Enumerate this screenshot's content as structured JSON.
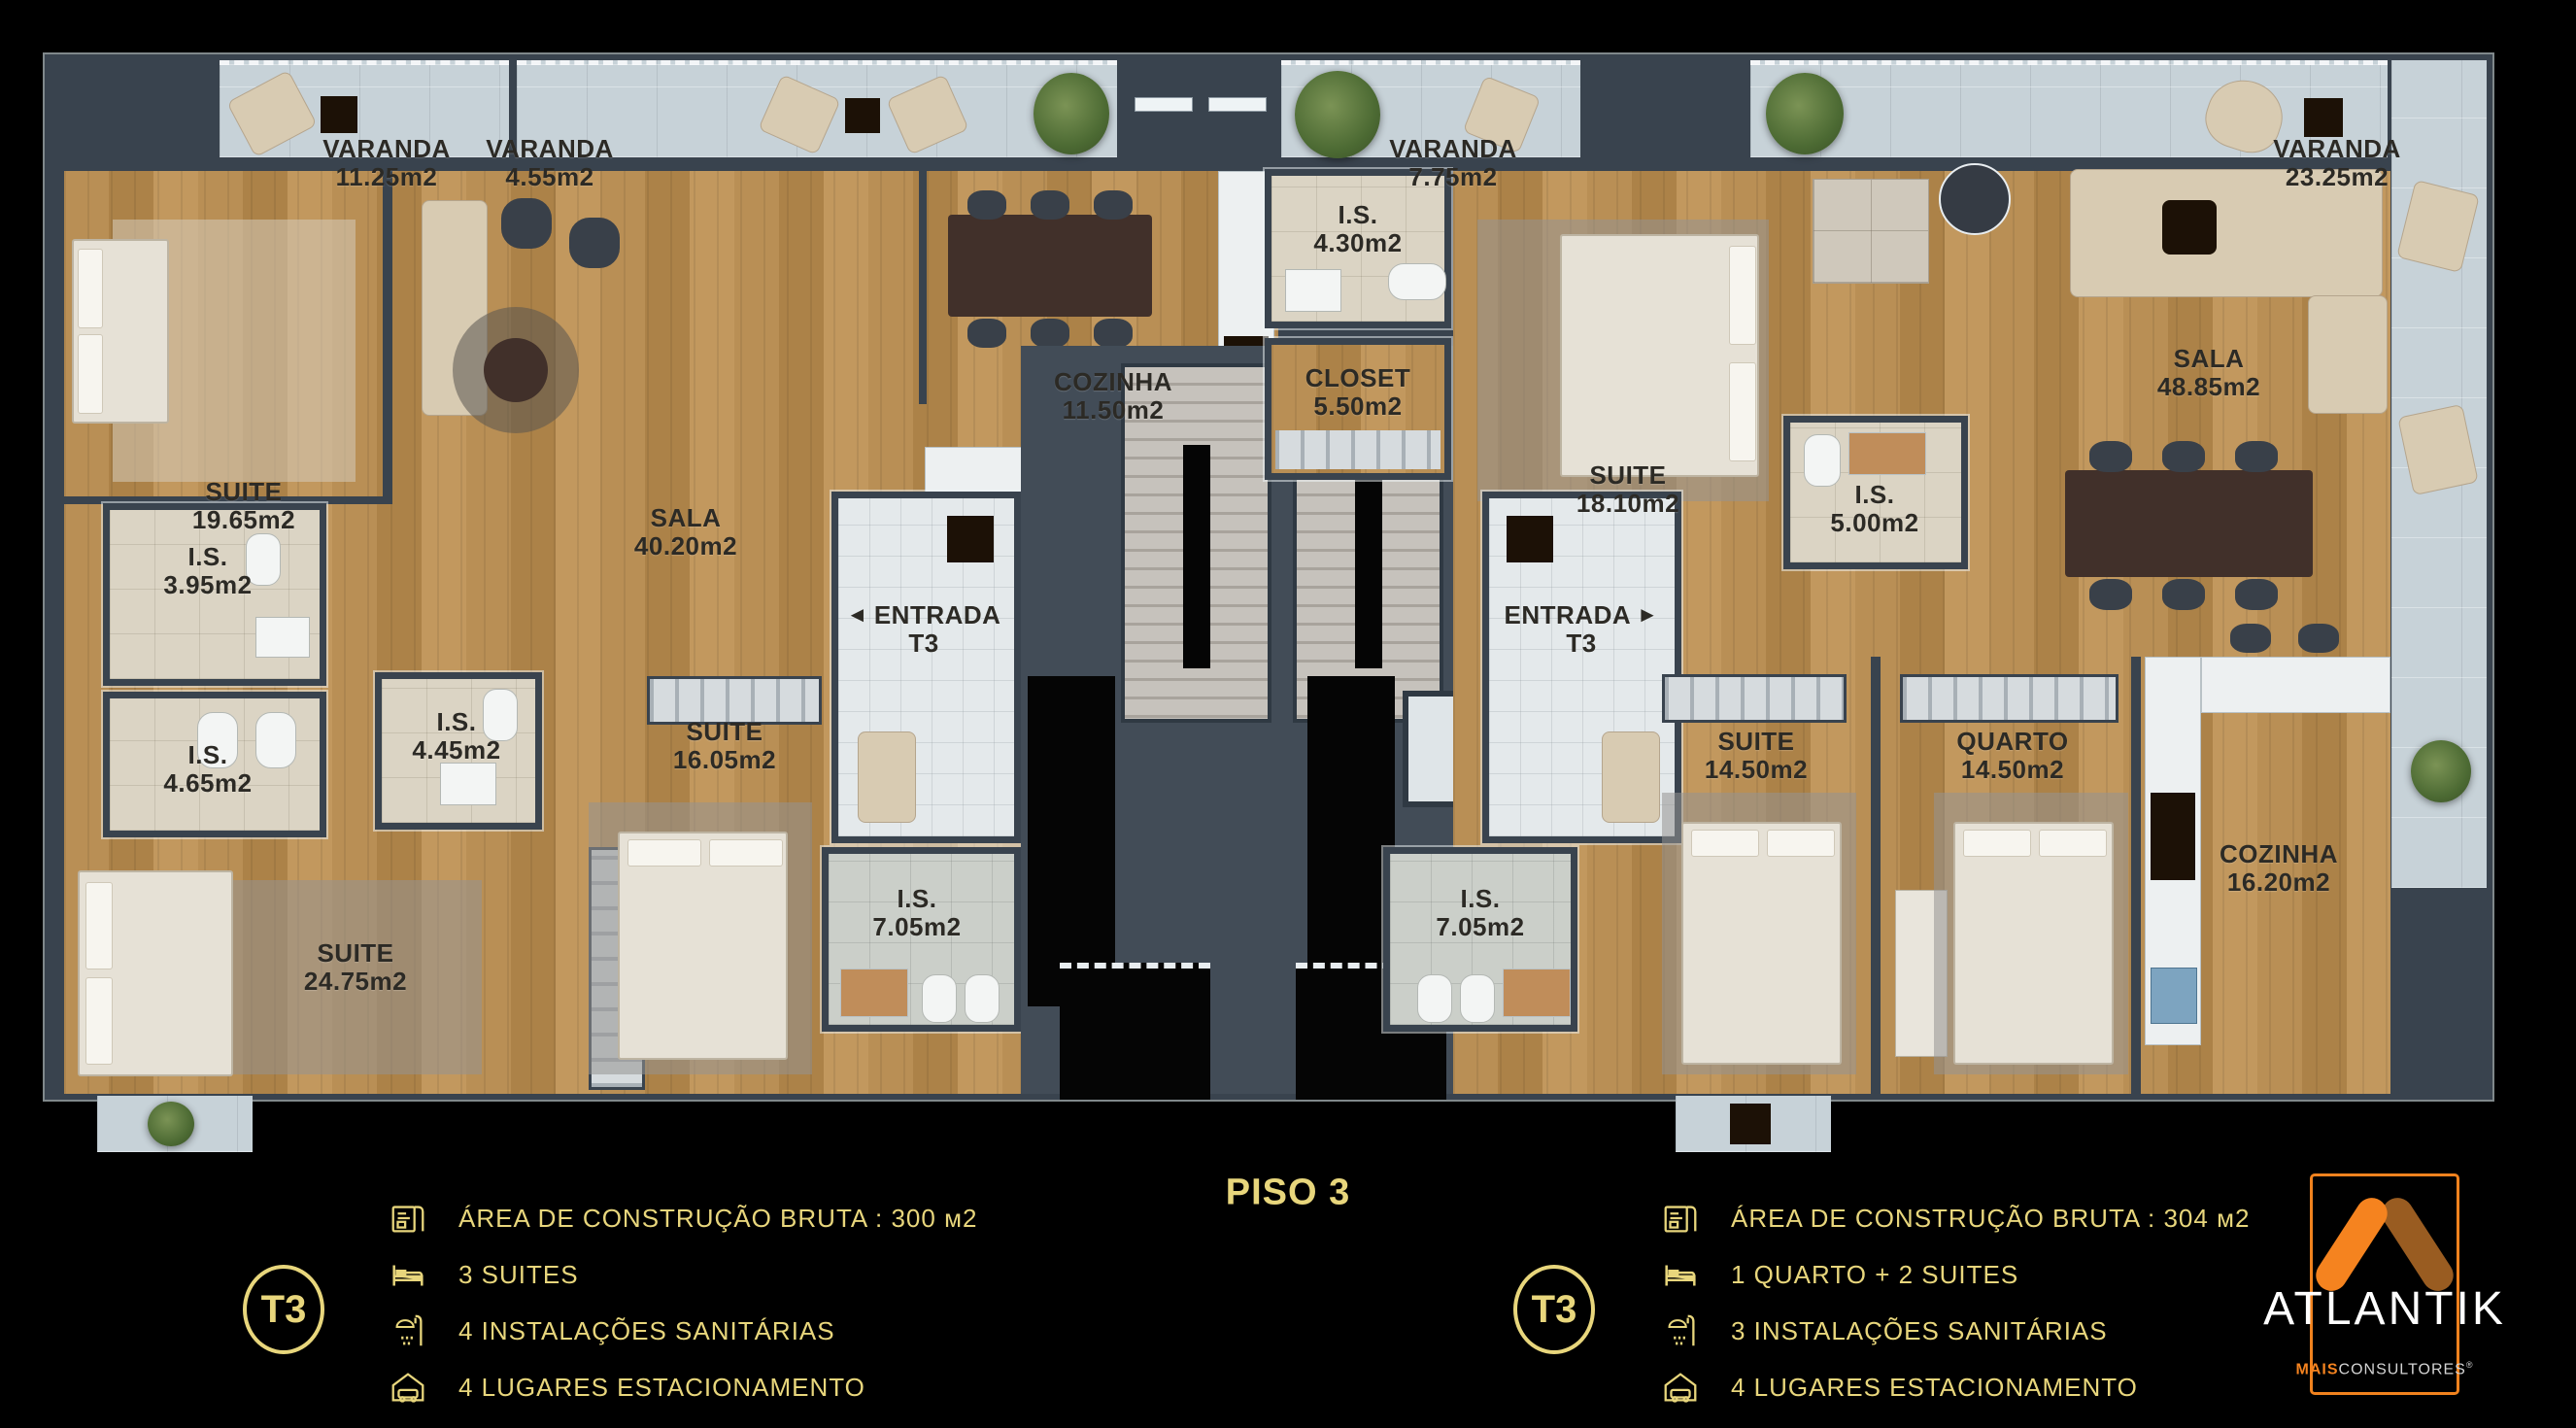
{
  "floor": {
    "label": "PISO 3"
  },
  "plan": {
    "varandas": [
      {
        "name": "VARANDA",
        "area": "4.55m2"
      },
      {
        "name": "VARANDA",
        "area": "11.25m2"
      },
      {
        "name": "VARANDA",
        "area": "7.75m2"
      },
      {
        "name": "VARANDA",
        "area": "23.25m2"
      }
    ],
    "left_unit": {
      "suite1": {
        "name": "SUITE",
        "area": "19.65m2"
      },
      "sala": {
        "name": "SALA",
        "area": "40.20m2"
      },
      "cozinha": {
        "name": "COZINHA",
        "area": "11.50m2"
      },
      "is1": {
        "name": "I.S.",
        "area": "3.95m2"
      },
      "is2": {
        "name": "I.S.",
        "area": "4.65m2"
      },
      "is3": {
        "name": "I.S.",
        "area": "4.45m2"
      },
      "suite2": {
        "name": "SUITE",
        "area": "24.75m2"
      },
      "suite3": {
        "name": "SUITE",
        "area": "16.05m2"
      },
      "entrada": {
        "arrow": "◄",
        "name": "ENTRADA",
        "sub": "T3"
      },
      "is4": {
        "name": "I.S.",
        "area": "7.05m2"
      }
    },
    "right_unit": {
      "is1": {
        "name": "I.S.",
        "area": "4.30m2"
      },
      "closet": {
        "name": "CLOSET",
        "area": "5.50m2"
      },
      "suite1": {
        "name": "SUITE",
        "area": "18.10m2"
      },
      "is2": {
        "name": "I.S.",
        "area": "5.00m2"
      },
      "sala": {
        "name": "SALA",
        "area": "48.85m2"
      },
      "entrada": {
        "name": "ENTRADA",
        "arrow": "►",
        "sub": "T3"
      },
      "suite2": {
        "name": "SUITE",
        "area": "14.50m2"
      },
      "quarto": {
        "name": "QUARTO",
        "area": "14.50m2"
      },
      "cozinha": {
        "name": "COZINHA",
        "area": "16.20m2"
      },
      "is3": {
        "name": "I.S.",
        "area": "7.05m2"
      }
    }
  },
  "legend": {
    "left": {
      "badge": "T3",
      "items": [
        {
          "icon": "blueprint-icon",
          "text": "ÁREA DE CONSTRUÇÃO BRUTA :  300 м2"
        },
        {
          "icon": "bed-icon",
          "text": "3 SUITES"
        },
        {
          "icon": "shower-icon",
          "text": "4 INSTALAÇÕES SANITÁRIAS"
        },
        {
          "icon": "garage-icon",
          "text": "4 LUGARES ESTACIONAMENTO"
        }
      ]
    },
    "right": {
      "badge": "T3",
      "items": [
        {
          "icon": "blueprint-icon",
          "text": "ÁREA DE CONSTRUÇÃO BRUTA :  304 м2"
        },
        {
          "icon": "bed-icon",
          "text": "1 QUARTO + 2 SUITES"
        },
        {
          "icon": "shower-icon",
          "text": "3 INSTALAÇÕES SANITÁRIAS"
        },
        {
          "icon": "garage-icon",
          "text": "4 LUGARES ESTACIONAMENTO"
        }
      ]
    }
  },
  "brand": {
    "name": "ATLANTIK",
    "sub_bold": "MAIS",
    "sub_rest": "CONSULTORES",
    "registered": "®"
  },
  "colors": {
    "legend_gold": "#e8d67c",
    "brand_orange": "#f5831f",
    "brand_brown": "#995c21",
    "wall": "#39434e",
    "wood": "#b98f55",
    "concrete": "#c7d2d8"
  }
}
